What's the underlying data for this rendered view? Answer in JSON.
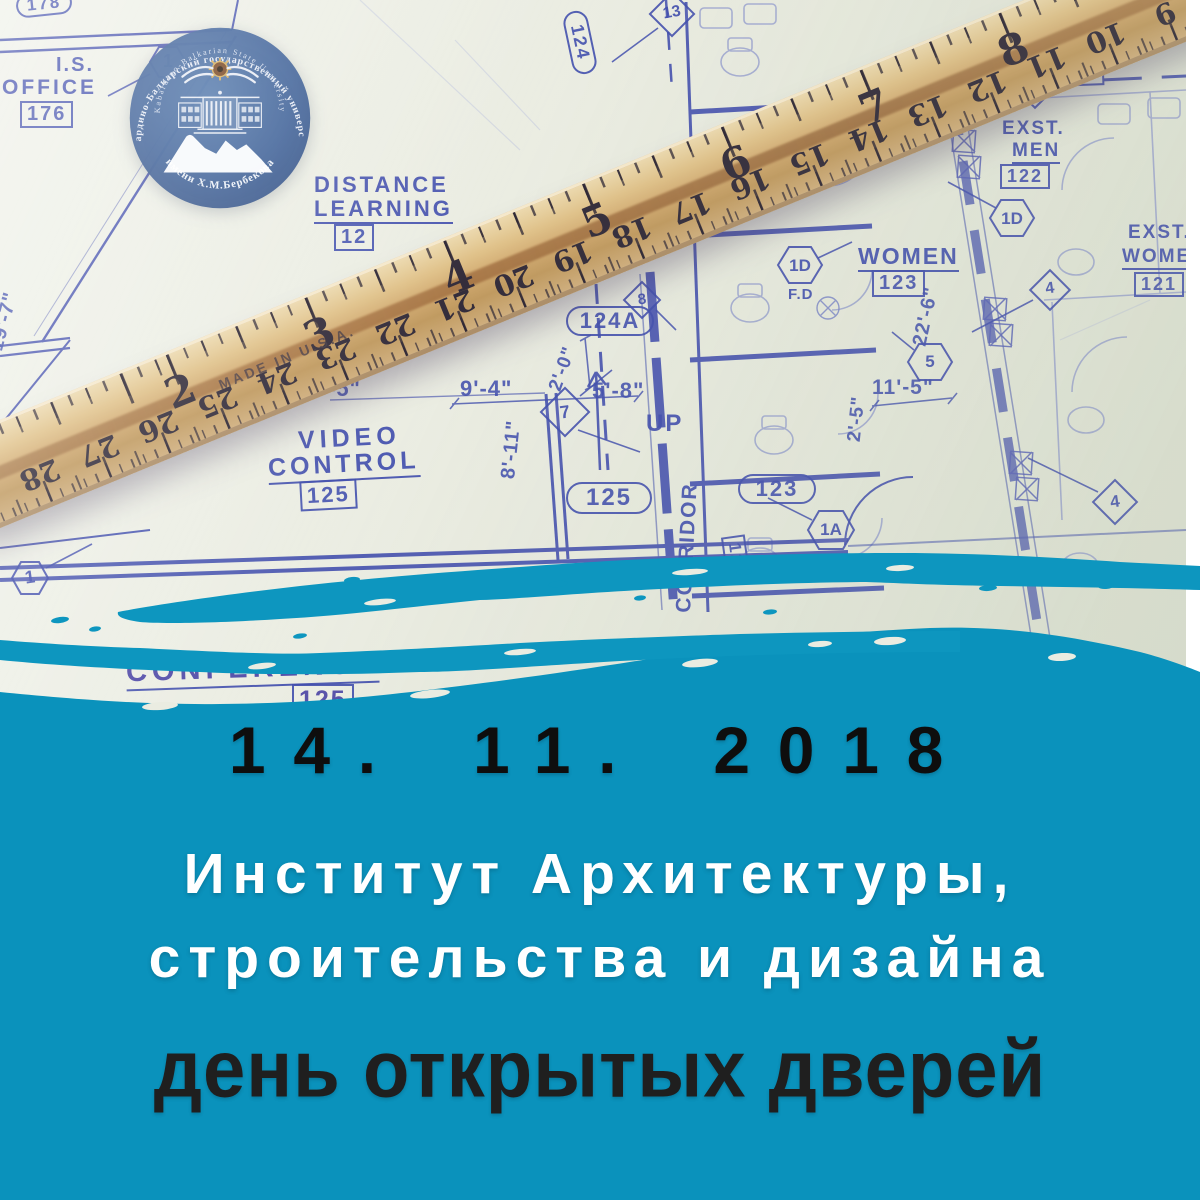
{
  "colors": {
    "teal": "#0a92bc",
    "teal_streak": "#0d96bf",
    "paper": "#eaece1",
    "ink": "#4350ae",
    "logo_blue": "#3e6198",
    "date_color": "#0e0e0e",
    "title_color": "#ffffff",
    "event_color": "#1f1f1f"
  },
  "poster": {
    "date": "14. 11. 2018",
    "institute_line1": "Институт Архитектуры,",
    "institute_line2": "строительства и дизайна",
    "event_title": "день открытых дверей"
  },
  "logo": {
    "outer_text_ru": "Кабардино-Балкарский государственный университет",
    "inner_text_en": "Kabardino-Balkarian State University",
    "bottom_text": "имени Х.М.Бербекова"
  },
  "ruler": {
    "made_in": "MADE IN U.S.A.",
    "top_numbers": [
      "2",
      "3",
      "4",
      "5",
      "6",
      "7",
      "8"
    ],
    "bottom_numbers": [
      "9",
      "10",
      "11",
      "12",
      "13",
      "14",
      "15",
      "16",
      "17",
      "18",
      "19",
      "20",
      "21",
      "22",
      "23",
      "24",
      "25",
      "26",
      "27",
      "28"
    ]
  },
  "blueprint": {
    "words": {
      "is": "I.S.",
      "office": "OFFICE",
      "distance": "DISTANCE",
      "learning": "LEARNING",
      "corridor": "CORRIDOR",
      "exst": "EXST.",
      "men": "MEN",
      "women": "WOMEN",
      "video": "VIDEO",
      "control": "CONTROL",
      "conference": "CONFERENCE",
      "up": "UP",
      "fd": "F.D"
    },
    "rooms": {
      "t178": "178",
      "t176": "176",
      "t12": "12",
      "t103": "103",
      "t106a": "106A",
      "t122": "122",
      "t123": "123",
      "t121": "121",
      "t124": "124",
      "t124a": "124A",
      "t125": "125",
      "t126": "126"
    },
    "tags": {
      "h1": "1",
      "h1d": "1D",
      "h5": "5",
      "h1a": "1A",
      "d13": "13",
      "d4": "4",
      "d8": "8",
      "d7": "7"
    },
    "dims": {
      "d19_7": "19'-7\"",
      "d14_8": "14'-8\"",
      "d10_0": "10'-0\"",
      "d9_4": "9'-4\"",
      "d5": "-5\"",
      "d8_11": "8'-11\"",
      "d2_0": "2'-0\"",
      "d5_8": "5'-8\"",
      "d2_5": "2'-5\"",
      "d11_5": "11'-5\"",
      "d22_6": "22'-6\""
    }
  }
}
